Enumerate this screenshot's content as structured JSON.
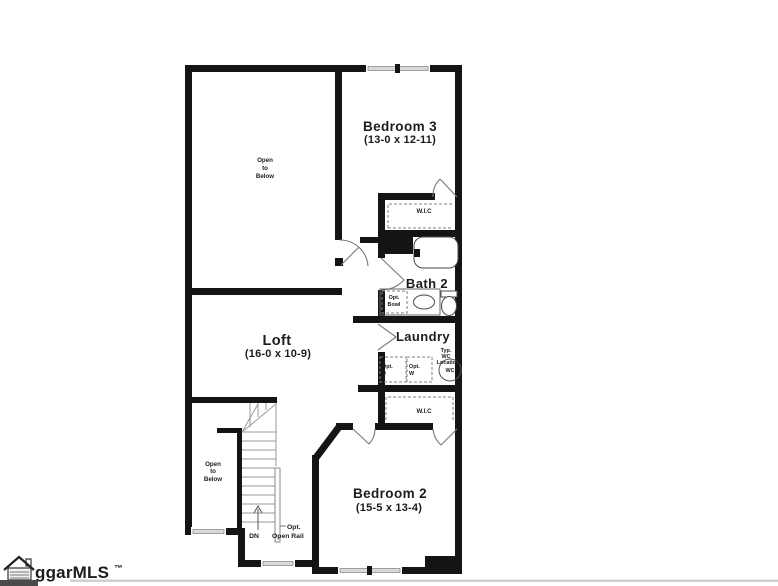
{
  "plan": {
    "rooms": {
      "bedroom3": {
        "name": "Bedroom 3",
        "dims": "(13-0 x 12-11)"
      },
      "loft": {
        "name": "Loft",
        "dims": "(16-0 x 10-9)"
      },
      "bedroom2": {
        "name": "Bedroom 2",
        "dims": "(15-5 x 13-4)"
      },
      "bath2": {
        "name": "Bath 2"
      },
      "laundry": {
        "name": "Laundry"
      },
      "wic_upper": {
        "name": "W.I.C"
      },
      "wic_lower": {
        "name": "W.I.C"
      }
    },
    "annotations": {
      "open_below_loft": {
        "l1": "Open",
        "l2": "to",
        "l3": "Below"
      },
      "open_below_stairs": {
        "l1": "Open",
        "l2": "to",
        "l3": "Below"
      },
      "opt_bowl": {
        "l1": "Opt.",
        "l2": "Bowl"
      },
      "typ_wc": {
        "l1": "Typ.",
        "l2": "WC",
        "l3": "Location"
      },
      "wc_label": "WC",
      "opt_dryer": {
        "l1": "Opt.",
        "l2": "D"
      },
      "opt_washer": {
        "l1": "Opt.",
        "l2": "W"
      },
      "down_label": "DN",
      "opt_rail": {
        "l1": "Opt.",
        "l2": "Open Rail"
      }
    }
  },
  "watermark": {
    "brand": "ggarMLS",
    "tm": "™"
  },
  "colors": {
    "wall": "#141414",
    "window": "#d9d9d9",
    "fixture_line": "#4a4a4a",
    "text": "#1c1c1c",
    "watermark_bar": "#4a4a4a",
    "watermark_rule": "#cfcfcf",
    "background": "#ffffff"
  }
}
